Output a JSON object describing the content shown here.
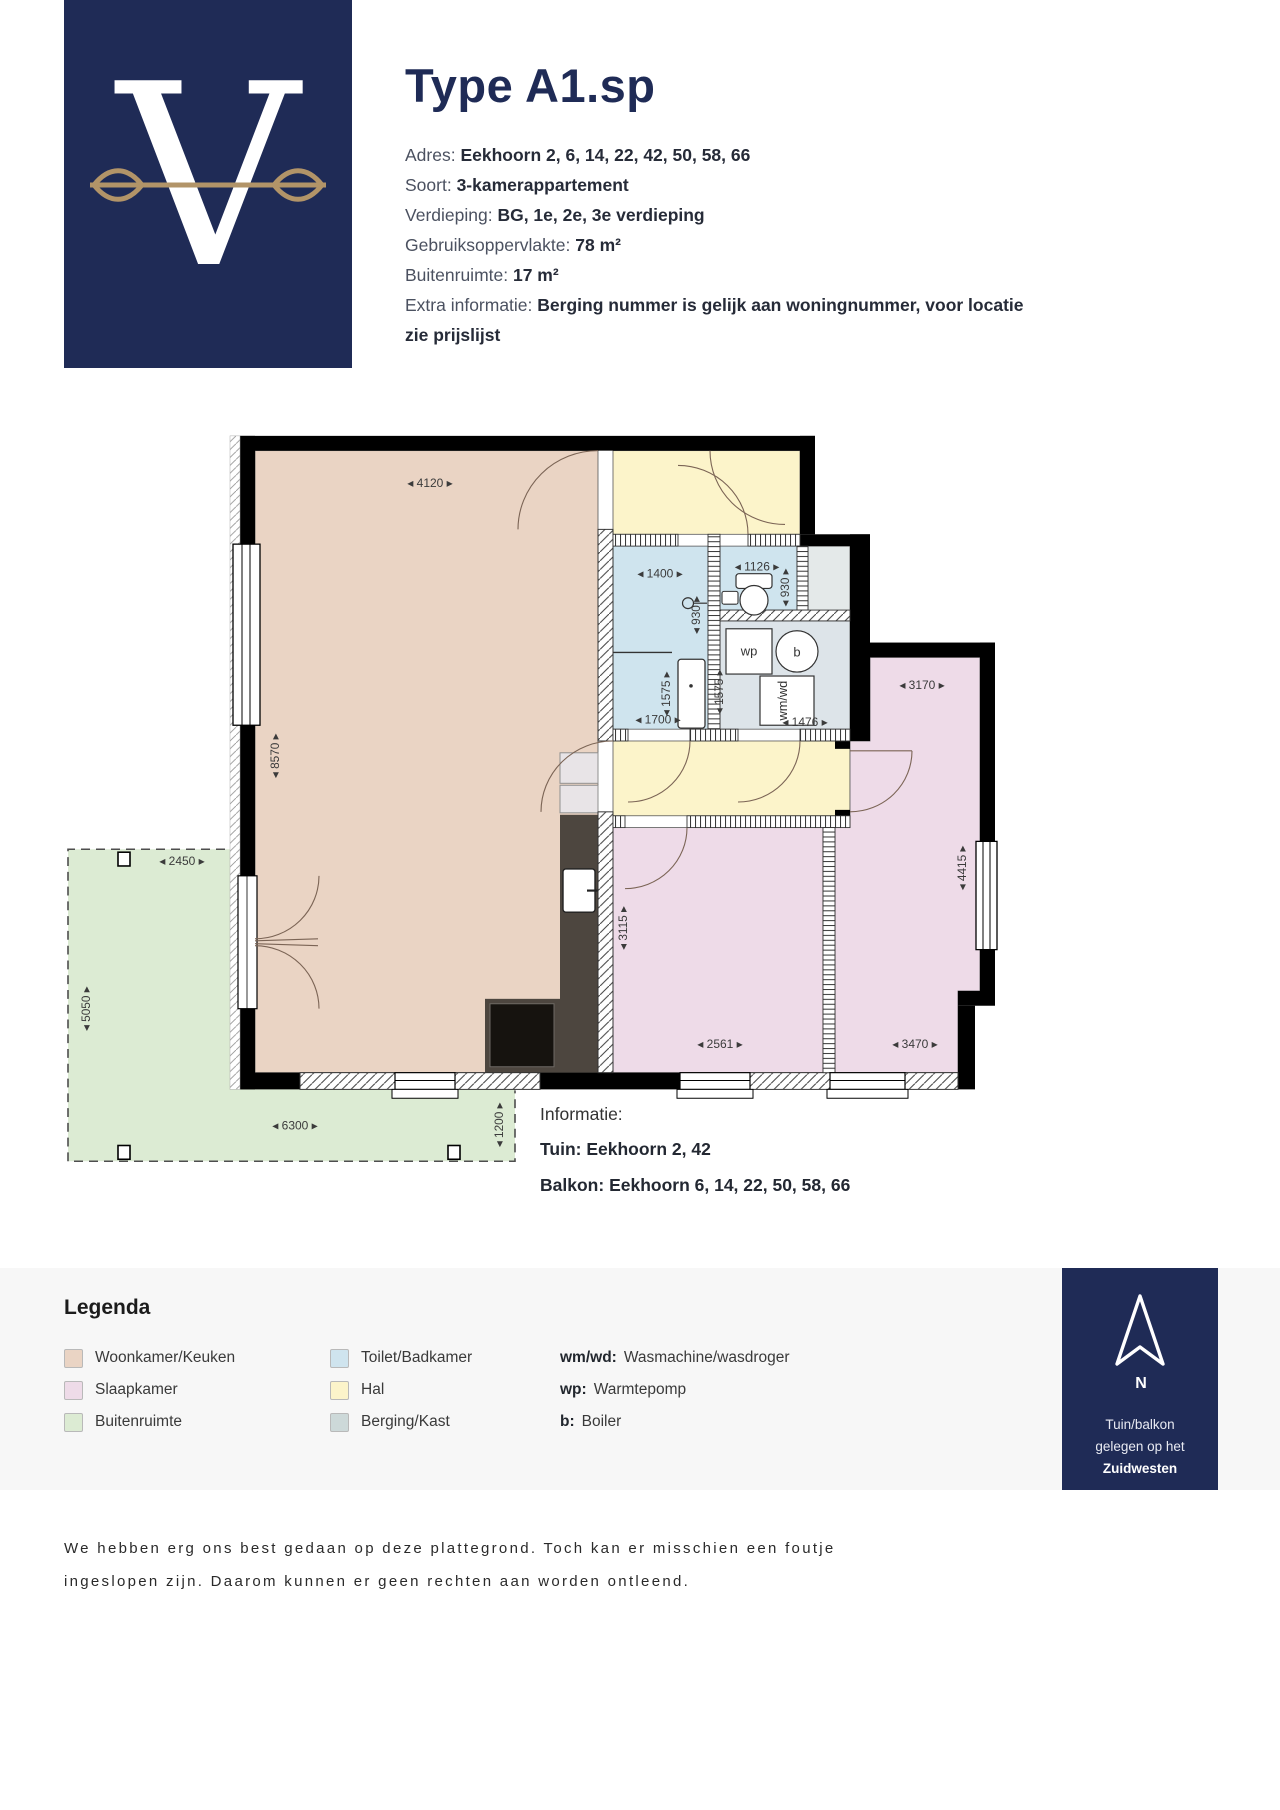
{
  "header": {
    "logo_letter": "V",
    "title": "Type A1.sp",
    "fields": [
      {
        "label": "Adres:",
        "value": "Eekhoorn 2, 6, 14, 22, 42, 50, 58, 66"
      },
      {
        "label": "Soort:",
        "value": "3-kamerappartement"
      },
      {
        "label": "Verdieping:",
        "value": "BG, 1e, 2e, 3e verdieping"
      },
      {
        "label": "Gebruiksoppervlakte:",
        "value": "78 m²"
      },
      {
        "label": "Buitenruimte:",
        "value": "17 m²"
      },
      {
        "label": "Extra informatie:",
        "value": "Berging nummer is gelijk aan woningnummer, voor locatie zie prijslijst"
      }
    ]
  },
  "plan": {
    "dims": {
      "living_w": "4120",
      "living_h": "8570",
      "bath_w": "1400",
      "bath_d": "930",
      "bath_inner": "1575",
      "bath_l": "1700",
      "toilet_w": "1126",
      "toilet_d": "930",
      "tech_d": "1575",
      "tech_w": "1476",
      "bed2_w": "3170",
      "bed2_h": "4415",
      "bed2_bw": "3470",
      "bed1_h": "3115",
      "bed1_w": "2561",
      "garden_w": "2450",
      "garden_h": "5050",
      "garden_bw": "6300",
      "garden_strip": "1200"
    },
    "fixtures": {
      "wp": "wp",
      "b": "b",
      "wmwd": "wm/wd"
    }
  },
  "info": {
    "title": "Informatie:",
    "lines": [
      {
        "label": "Tuin:",
        "value": "Eekhoorn 2, 42"
      },
      {
        "label": "Balkon:",
        "value": "Eekhoorn 6, 14, 22, 50, 58, 66"
      }
    ]
  },
  "legend": {
    "title": "Legenda",
    "items": [
      {
        "label": "Woonkamer/Keuken",
        "color": "#ead4c4"
      },
      {
        "label": "Slaapkamer",
        "color": "#eedbe8"
      },
      {
        "label": "Buitenruimte",
        "color": "#dcebd3"
      },
      {
        "label": "Toilet/Badkamer",
        "color": "#cfe4ee"
      },
      {
        "label": "Hal",
        "color": "#fcf4ca"
      },
      {
        "label": "Berging/Kast",
        "color": "#cdd9d9"
      }
    ],
    "abbrs": [
      {
        "abbr": "wm/wd:",
        "label": "Wasmachine/wasdroger"
      },
      {
        "abbr": "wp:",
        "label": "Warmtepomp"
      },
      {
        "abbr": "b:",
        "label": "Boiler"
      }
    ]
  },
  "compass": {
    "north": "N",
    "lines": [
      "Tuin/balkon",
      "gelegen op het",
      "Zuidwesten"
    ]
  },
  "footer": {
    "line1": "We hebben erg ons best gedaan op deze plattegrond. Toch kan er misschien een foutje",
    "line2": "ingeslopen zijn. Daarom kunnen er geen rechten aan worden ontleend."
  }
}
